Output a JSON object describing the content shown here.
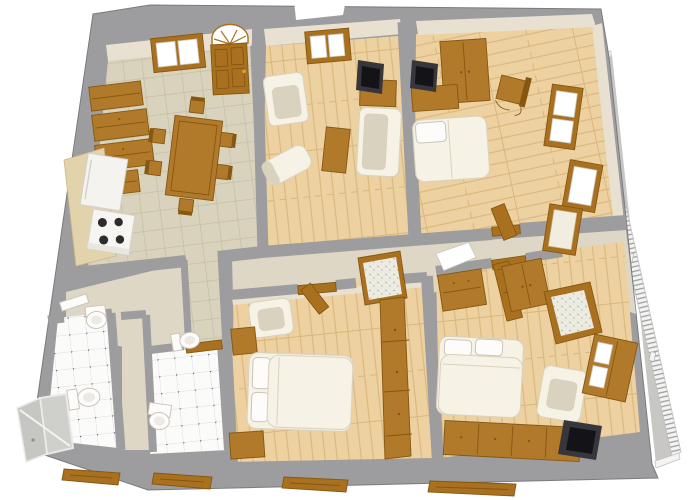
{
  "meta": {
    "description": "3D overhead perspective floor-plan render of a four-room apartment with two bathrooms and a right-side balcony",
    "projection": "perspective overhead",
    "visible_text": "none"
  },
  "colors": {
    "background": "#ffffff",
    "wall": "#9d9c9e",
    "wallEdge": "#7b7a7e",
    "wallFace": "#e8e1d1",
    "hallFloor": "#ded7c5",
    "tileFloor": "#d9d2bc",
    "tileLine": "#c3bba2",
    "wood": "#edd1a1",
    "woodLine": "#d9b77c",
    "bathTile": "#fbfbfa",
    "bathGrout": "#dedede",
    "bathDot": "#333d5e",
    "furnWood": "#b1792a",
    "furnWoodDark": "#855711",
    "doorBrown": "#a9711f",
    "whiteFurn": "#f6f2e5",
    "whiteFurnShade": "#d9d2bf",
    "fixtureWhite": "#fdfcfa",
    "fixtureLine": "#c9c5ba",
    "tv": "#36363c",
    "tvScreen": "#131318",
    "balconyFloor": "#c8c7c4",
    "railing": "#f4f4f3",
    "railSlat": "#9e9e9e",
    "shower": "#cfcfcc",
    "counter": "#e3d3ac",
    "counterLine": "#cbb887"
  },
  "balcony": {
    "position": "right-edge",
    "railing": "white-with-slats",
    "floor": "concrete-gray"
  },
  "rooms": [
    {
      "id": "kitchen-dining",
      "position": "top-left",
      "floor": "beige-ceramic-tile",
      "items": [
        "entry-door-with-arched-fanlight",
        "window",
        "cabinet-stack-x3",
        "kitchen-counter",
        "refrigerator",
        "stove-4-burners",
        "dining-table",
        "dining-chairs-x6"
      ]
    },
    {
      "id": "living-room",
      "position": "top-center",
      "floor": "wood-planks",
      "items": [
        "window",
        "armchair",
        "sofa",
        "chaise-longue",
        "coffee-table",
        "tv-on-cabinet"
      ]
    },
    {
      "id": "bedroom-1",
      "position": "top-right",
      "floor": "wood-planks",
      "items": [
        "wardrobe",
        "tv-on-cabinet",
        "chair",
        "bed-with-pillow",
        "balcony-door",
        "balcony-window"
      ]
    },
    {
      "id": "hallway",
      "position": "center",
      "floor": "plaster-and-tile",
      "items": [
        "open-door-to-bedroom-1",
        "standing-door-frame",
        "open-door-to-bedroom-3",
        "tiled-doorway-to-bedroom-2",
        "corridor-tile-strip"
      ]
    },
    {
      "id": "bathroom-1",
      "position": "bottom-left",
      "floor": "white-tile-with-navy-dots",
      "items": [
        "pedestal-sink",
        "toilet",
        "shower-cabin",
        "white-door"
      ]
    },
    {
      "id": "bathroom-2",
      "position": "bottom-left-inner",
      "floor": "white-tile-with-navy-dots",
      "items": [
        "pedestal-sink",
        "toilet",
        "door-threshold"
      ]
    },
    {
      "id": "bedroom-2",
      "position": "bottom-center",
      "floor": "wood-planks",
      "items": [
        "armchair",
        "chest",
        "double-bed-2-pillows",
        "nightstand",
        "wardrobe-wall-unit"
      ]
    },
    {
      "id": "bedroom-3",
      "position": "bottom-right",
      "floor": "wood-planks",
      "items": [
        "dressing-table-with-mirror",
        "wardrobe",
        "double-bed-2-pillows",
        "armchair",
        "display-cabinet",
        "sideboard",
        "tv",
        "corner-balcony-door"
      ]
    }
  ],
  "exterior": {
    "bottom_wall_window_sills": 4,
    "background": "white"
  }
}
